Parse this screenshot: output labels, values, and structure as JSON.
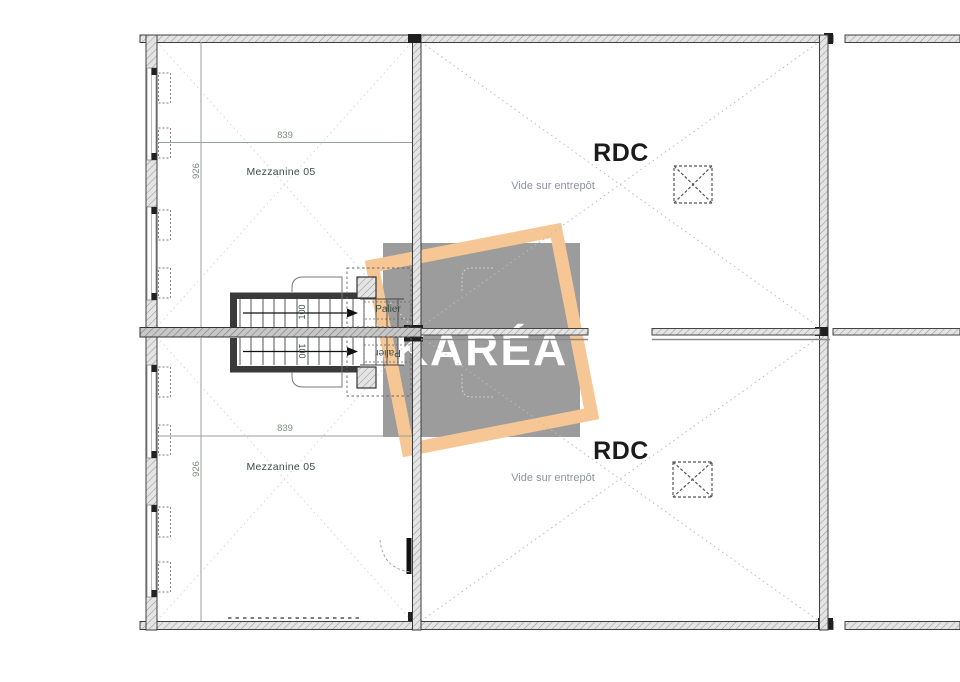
{
  "plan": {
    "rooms": {
      "mezzanine_top": {
        "label": "Mezzanine 05",
        "width_dim": "839",
        "height_dim": "926"
      },
      "mezzanine_bottom": {
        "label": "Mezzanine 05",
        "width_dim": "839",
        "height_dim": "926"
      },
      "rdc_top": {
        "label": "RDC",
        "sublabel": "Vide sur entrepôt"
      },
      "rdc_bottom": {
        "label": "RDC",
        "sublabel": "Vide sur entrepôt"
      }
    },
    "stairs": {
      "top": {
        "landing_label": "Palier",
        "width_label": "100"
      },
      "bottom": {
        "landing_label": "Palier",
        "width_label": "100"
      }
    }
  },
  "watermark": {
    "brand": "KARÉA"
  },
  "colors": {
    "accent": "#f6c795",
    "watermark": "#9c9c9c",
    "room": "#3d4f47",
    "dim": "#7f8d84",
    "muted": "#8d939e",
    "ink": "#1b1b1b"
  }
}
